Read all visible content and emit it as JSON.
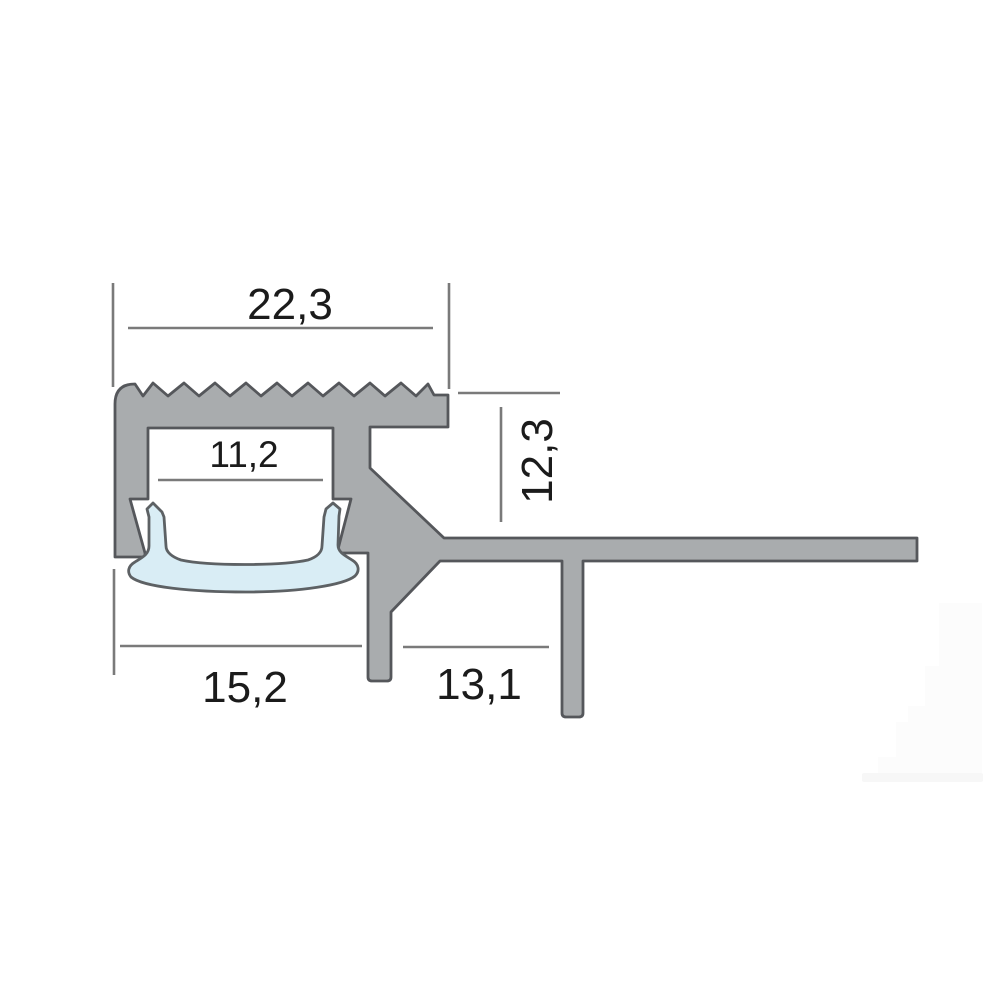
{
  "diagram": {
    "title": "profile-cross-section-drawing",
    "dimensions": {
      "top_width": "22,3",
      "inner_channel_width": "11,2",
      "right_height": "12,3",
      "bottom_left_width": "15,2",
      "bottom_middle_width": "13,1"
    },
    "colors": {
      "background": "#ffffff",
      "profile_fill": "#a9acae",
      "profile_outline": "#55575b",
      "insert_fill": "#d9edf5",
      "insert_outline": "#5d6164",
      "dimension_line": "#7a7a7a",
      "text": "#1b1b1b",
      "watermark": "#fcfcfc",
      "watermark_base": "#f7f7f7"
    }
  }
}
